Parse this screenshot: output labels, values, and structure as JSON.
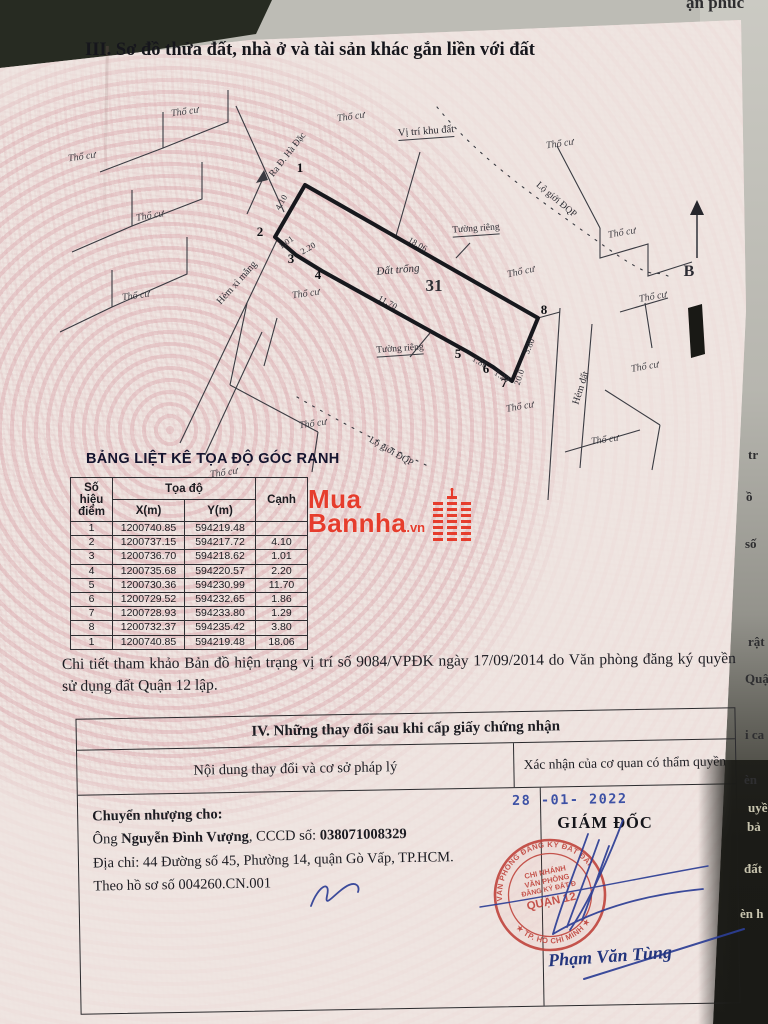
{
  "photo": {
    "top_fragment": "ận phúc",
    "side_fragments": [
      "tr",
      "ồ",
      "số",
      "rật",
      "Quậ",
      "i ca",
      "èn",
      "uyề",
      "bả",
      "đất",
      "èn h"
    ]
  },
  "section3": {
    "title": "III. Sơ đồ thửa đất, nhà ở và tài sản khác gắn liền với đất"
  },
  "diagram": {
    "plot_number": "31",
    "plot_status_label": "Đất trống",
    "location_label": "Vị trí khu đất",
    "street_label": "Ra Đ. Hà Đặc",
    "alley_concrete_label": "Hẻm xi măng",
    "alley_dirt_label": "Hẻm đất",
    "road_boundary_label": "Lộ giới ĐQP",
    "private_wall_label": "Tường riêng",
    "residential_label": "Thổ cư",
    "north_label": "B",
    "point_labels": [
      "1",
      "2",
      "3",
      "4",
      "5",
      "6",
      "7",
      "8"
    ],
    "edge_lengths": {
      "e12": "4.10",
      "e23": "1.01",
      "e34": "2.20",
      "e45": "11.70",
      "e56": "1.86",
      "e67": "1.29",
      "e78": "3.80",
      "e81": "18.06",
      "alley_width": "20.0"
    }
  },
  "coords_table": {
    "title": "BẢNG LIỆT KÊ TỌA ĐỘ GÓC RANH",
    "header": {
      "point_line1": "Số hiệu",
      "point_line2": "điểm",
      "coords": "Tọa độ",
      "x": "X(m)",
      "y": "Y(m)",
      "edge": "Cạnh"
    },
    "rows": [
      {
        "point": "1",
        "x": "1200740.85",
        "y": "594219.48",
        "edge": ""
      },
      {
        "point": "2",
        "x": "1200737.15",
        "y": "594217.72",
        "edge": "4.10"
      },
      {
        "point": "3",
        "x": "1200736.70",
        "y": "594218.62",
        "edge": "1.01"
      },
      {
        "point": "4",
        "x": "1200735.68",
        "y": "594220.57",
        "edge": "2.20"
      },
      {
        "point": "5",
        "x": "1200730.36",
        "y": "594230.99",
        "edge": "11.70"
      },
      {
        "point": "6",
        "x": "1200729.52",
        "y": "594232.65",
        "edge": "1.86"
      },
      {
        "point": "7",
        "x": "1200728.93",
        "y": "594233.80",
        "edge": "1.29"
      },
      {
        "point": "8",
        "x": "1200732.37",
        "y": "594235.42",
        "edge": "3.80"
      },
      {
        "point": "1",
        "x": "1200740.85",
        "y": "594219.48",
        "edge": "18.06"
      }
    ]
  },
  "watermark": {
    "line1": "Mua",
    "line2": "Bannha",
    "tld": ".vn"
  },
  "note": "Chi tiết tham khảo Bản đồ hiện trạng vị trí số 9084/VPĐK ngày 17/09/2014 do Văn phòng đăng ký quyền sử dụng đất Quận 12 lập.",
  "section4": {
    "title": "IV. Những thay đổi sau khi cấp giấy chứng nhận",
    "col_left": "Nội dung thay đổi và cơ sở pháp lý",
    "col_right": "Xác nhận của cơ quan có thẩm quyền",
    "transfer": {
      "heading": "Chuyển nhượng cho:",
      "prefix": "Ông ",
      "name": "Nguyễn Đình Vượng",
      "cccd_label": ", CCCD số: ",
      "cccd_number": "038071008329",
      "address": "Địa chỉ: 44 Đường số 45, Phường 14, quận Gò Vấp, TP.HCM.",
      "dossier": "Theo hồ sơ số  004260.CN.001"
    },
    "approval": {
      "date_stamp": "28 -01- 2022",
      "director_title": "GIÁM ĐỐC",
      "stamp_ring_top": "VĂN PHÒNG ĐĂNG KÝ ĐẤT ĐAI",
      "stamp_ring_bottom": "★ TP. HỒ CHÍ MINH ★",
      "stamp_line1": "CHI NHÁNH",
      "stamp_line2": "VĂN PHÒNG",
      "stamp_line3": "ĐĂNG KÝ ĐẤT Đ",
      "stamp_line4": "QUẬN 12",
      "signer_name": "Phạm Văn Tùng"
    }
  }
}
